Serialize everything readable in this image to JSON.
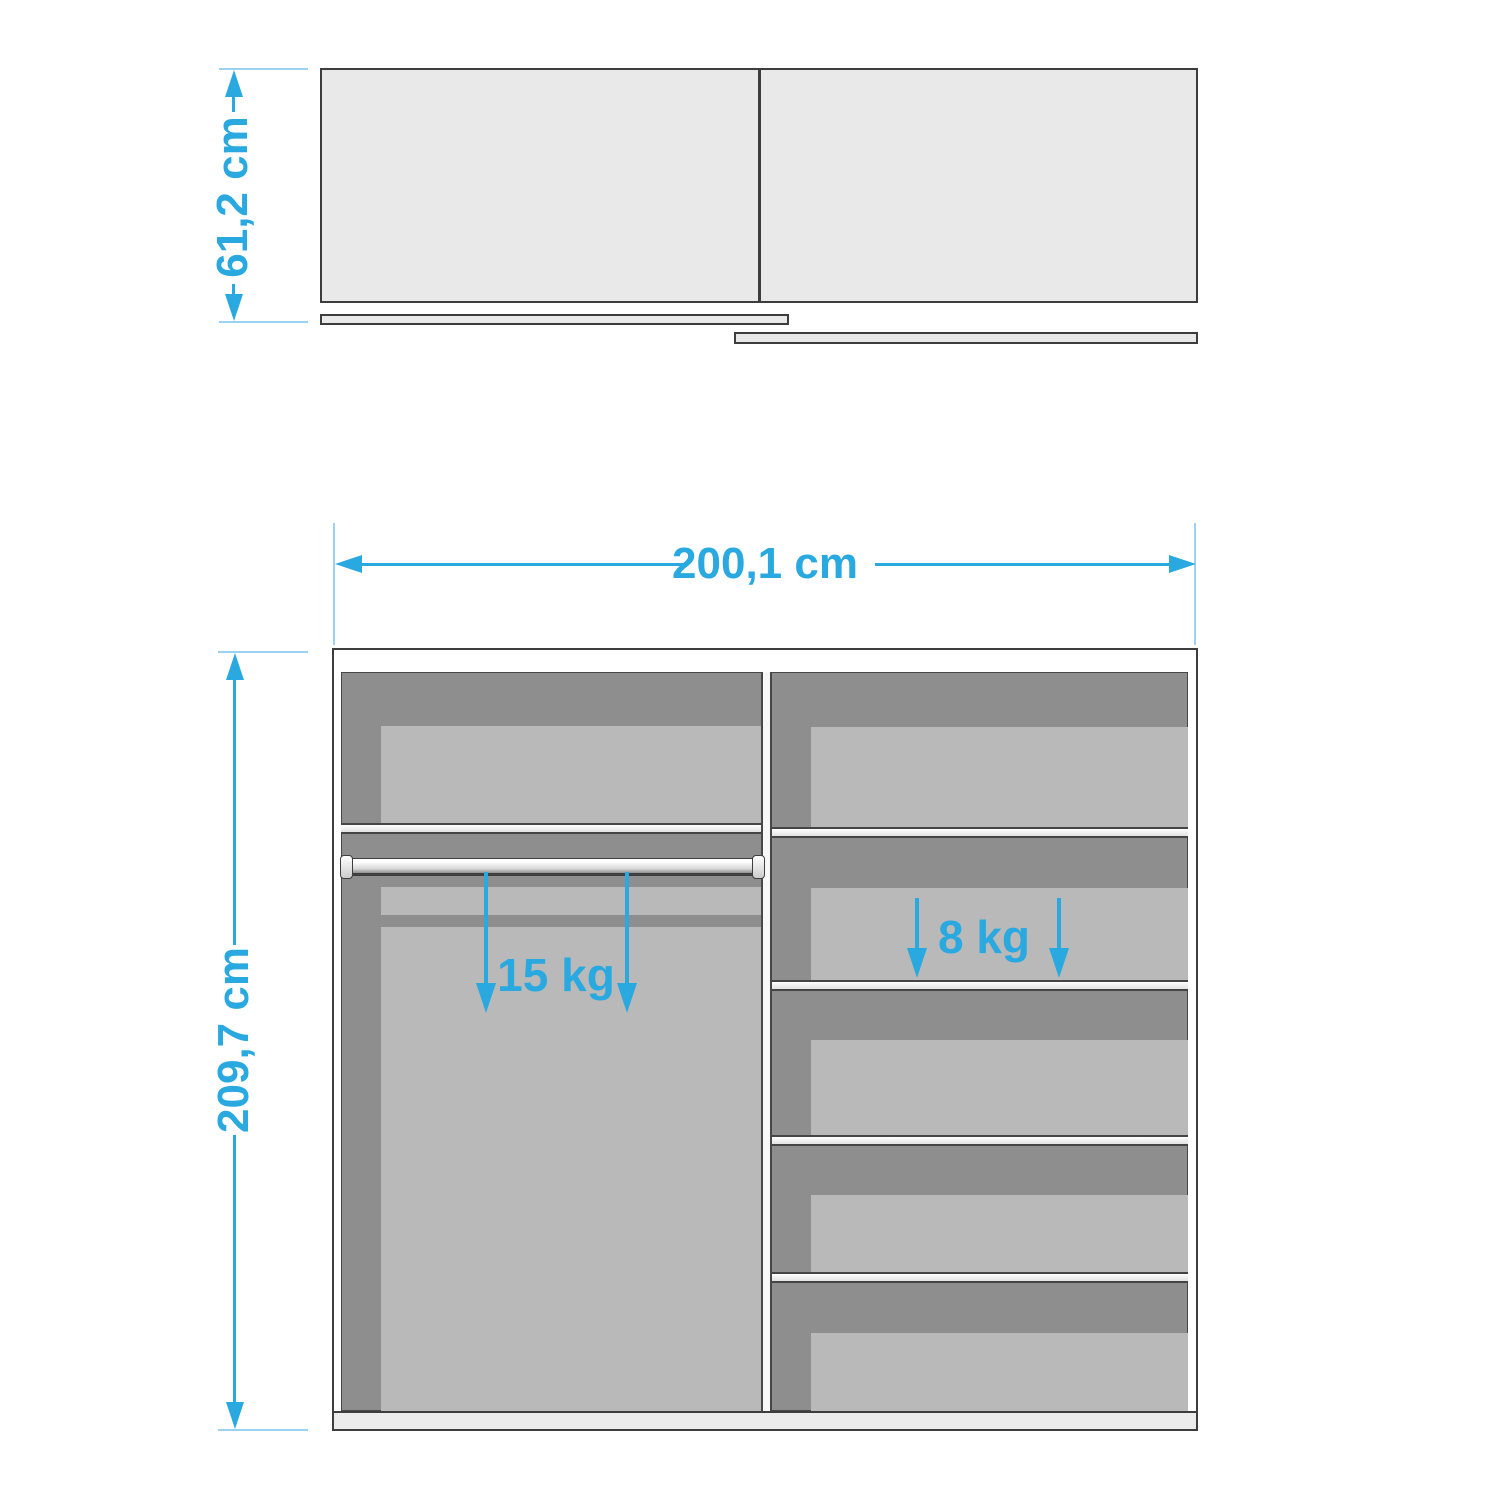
{
  "diagram": {
    "type": "wardrobe-dimension-drawing",
    "views": {
      "plan_view": {
        "description": "top view of wardrobe body with two sliding door rails",
        "depth_label": "61,2 cm"
      },
      "front_view": {
        "description": "front view of wardrobe interior with hanging rail and shelves",
        "width_label": "200,1 cm",
        "height_label": "209,7 cm",
        "rail_capacity_label": "15 kg",
        "shelf_capacity_label": "8 kg",
        "right_column_shelf_count": 4,
        "left_column_shelf_count": 1
      }
    },
    "colors": {
      "dimension_accent": "#29a9e0",
      "guide_line": "#9ad2f0",
      "interior_dark": "#8e8e8e",
      "interior_light": "#b9b9b9",
      "outline": "#3d3d3d",
      "carcass_fill": "#e9e9e9",
      "background": "#ffffff"
    }
  }
}
